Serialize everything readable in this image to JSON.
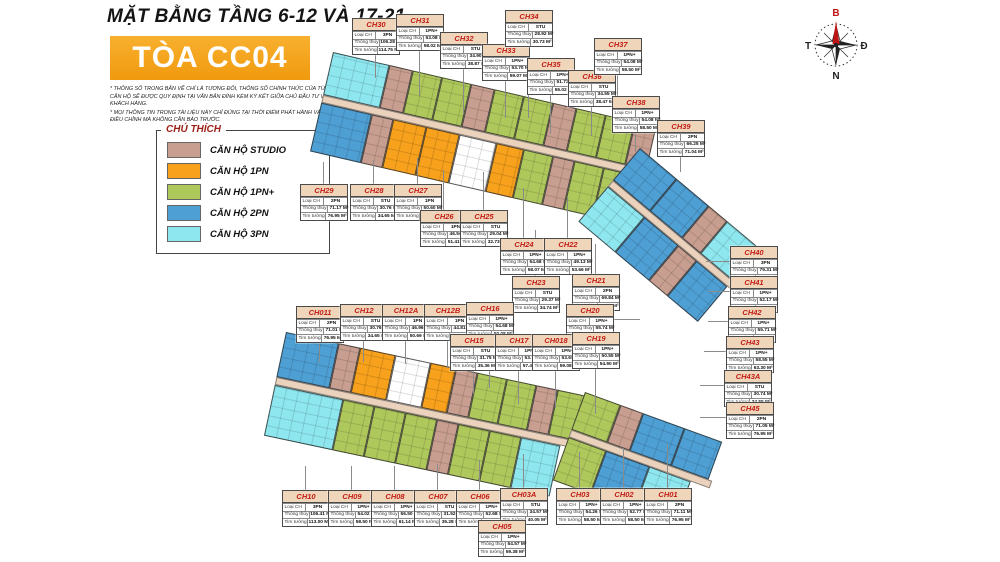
{
  "header": {
    "title": "MẶT BẰNG TẦNG 6-12 VÀ 17-21",
    "tower": "TÒA CC04",
    "notes": [
      "* THÔNG SỐ TRONG BẢN VẼ CHỈ LÀ TƯƠNG ĐỐI, THÔNG SỐ CHÍNH THỨC CỦA TỪNG CĂN HỘ SẼ ĐƯỢC QUY ĐỊNH TẠI VĂN BẢN ĐÍNH KÈM KÝ KẾT GIỮA CHỦ ĐẦU TƯ VÀ KHÁCH HÀNG.",
      "* MỌI THÔNG TIN TRONG TÀI LIỆU NÀY CHỈ ĐÚNG TẠI THỜI ĐIỂM PHÁT HÀNH VÀ CÓ THỂ ĐIỀU CHỈNH MÀ KHÔNG CẦN BÁO TRƯỚC."
    ]
  },
  "legend": {
    "title": "CHÚ THÍCH",
    "items": [
      {
        "key": "STU",
        "label": "CĂN HỘ STUDIO",
        "color": "#c79e8f"
      },
      {
        "key": "1PN",
        "label": "CĂN HỘ 1PN",
        "color": "#f7a11c"
      },
      {
        "key": "1PN+",
        "label": "CĂN HỘ 1PN+",
        "color": "#afc85c"
      },
      {
        "key": "2PN",
        "label": "CĂN HỘ 2PN",
        "color": "#4e9fd4"
      },
      {
        "key": "3PN",
        "label": "CĂN HỘ 3PN",
        "color": "#8ee7ef"
      }
    ],
    "corridor_color": "#ebd2bc",
    "core_color": "#ffffff"
  },
  "compass": {
    "north": "B",
    "east": "Đ",
    "south": "N",
    "west": "T"
  },
  "card_labels": {
    "type": "Loại CH",
    "clear": "Thông thủy",
    "wall": "Tim tường"
  },
  "units": [
    {
      "id": "CH30",
      "type": "3PN",
      "clear": "106.28 M²",
      "wall": "114.75 M²"
    },
    {
      "id": "CH31",
      "type": "1PN+",
      "clear": "53.08 M²",
      "wall": "58.02 M²"
    },
    {
      "id": "CH32",
      "type": "STU",
      "clear": "34.90 M²",
      "wall": "38.87 M²"
    },
    {
      "id": "CH33",
      "type": "1PN+",
      "clear": "53.70 M²",
      "wall": "59.07 M²"
    },
    {
      "id": "CH34",
      "type": "STU",
      "clear": "28.92 M²",
      "wall": "30.73 M²"
    },
    {
      "id": "CH35",
      "type": "1PN+",
      "clear": "51.73 M²",
      "wall": "55.02 M²"
    },
    {
      "id": "CH36",
      "type": "STU",
      "clear": "34.55 M²",
      "wall": "38.47 M²"
    },
    {
      "id": "CH37",
      "type": "1PN+",
      "clear": "54.08 M²",
      "wall": "58.50 M²"
    },
    {
      "id": "CH38",
      "type": "1PN+",
      "clear": "54.08 M²",
      "wall": "58.50 M²"
    },
    {
      "id": "CH39",
      "type": "2PN",
      "clear": "66.25 M²",
      "wall": "71.04 M²"
    },
    {
      "id": "CH29",
      "type": "2PN",
      "clear": "71.17 M²",
      "wall": "76.95 M²"
    },
    {
      "id": "CH28",
      "type": "STU",
      "clear": "30.76 M²",
      "wall": "34.65 M²"
    },
    {
      "id": "CH27",
      "type": "1PN",
      "clear": "50.60 M²",
      "wall": "55.48 M²"
    },
    {
      "id": "CH26",
      "type": "1PN",
      "clear": "46.56 M²",
      "wall": "51.41 M²"
    },
    {
      "id": "CH25",
      "type": "STU",
      "clear": "29.04 M²",
      "wall": "32.73 M²"
    },
    {
      "id": "CH24",
      "type": "1PN+",
      "clear": "54.68 M²",
      "wall": "58.07 M²"
    },
    {
      "id": "CH23",
      "type": "STU",
      "clear": "29.37 M²",
      "wall": "34.74 M²"
    },
    {
      "id": "CH22",
      "type": "1PN+",
      "clear": "49.13 M²",
      "wall": "53.66 M²"
    },
    {
      "id": "CH21",
      "type": "2PN",
      "clear": "69.84 M²",
      "wall": "74.82 M²"
    },
    {
      "id": "CH20",
      "type": "1PN+",
      "clear": "55.74 M²",
      "wall": "60.30 M²"
    },
    {
      "id": "CH40",
      "type": "3PN",
      "clear": "79.31 M²",
      "wall": "85.34 M²"
    },
    {
      "id": "CH41",
      "type": "1PN+",
      "clear": "52.17 M²",
      "wall": "56.70 M²"
    },
    {
      "id": "CH42",
      "type": "1PN+",
      "clear": "55.71 M²",
      "wall": "60.30 M²"
    },
    {
      "id": "CH43",
      "type": "1PN+",
      "clear": "58.55 M²",
      "wall": "63.30 M²"
    },
    {
      "id": "CH43A",
      "type": "STU",
      "clear": "30.74 M²",
      "wall": "34.55 M²"
    },
    {
      "id": "CH45",
      "type": "2PN",
      "clear": "71.05 M²",
      "wall": "76.95 M²"
    },
    {
      "id": "CH011",
      "type": "2PN",
      "clear": "71.01 M²",
      "wall": "76.95 M²"
    },
    {
      "id": "CH12",
      "type": "STU",
      "clear": "30.76 M²",
      "wall": "34.65 M²"
    },
    {
      "id": "CH12A",
      "type": "1PN",
      "clear": "46.96 M²",
      "wall": "50.69 M²"
    },
    {
      "id": "CH12B",
      "type": "1PN",
      "clear": "44.81 M²",
      "wall": "48.15 M²"
    },
    {
      "id": "CH16",
      "type": "1PN+",
      "clear": "54.68 M²",
      "wall": "59.08 M²"
    },
    {
      "id": "CH15",
      "type": "STU",
      "clear": "31.75 M²",
      "wall": "35.36 M²"
    },
    {
      "id": "CH17",
      "type": "1PN+",
      "clear": "53.74 M²",
      "wall": "57.45 M²"
    },
    {
      "id": "CH018",
      "type": "1PN+",
      "clear": "53.65 M²",
      "wall": "59.08 M²"
    },
    {
      "id": "CH19",
      "type": "1PN+",
      "clear": "50.55 M²",
      "wall": "54.90 M²"
    },
    {
      "id": "CH10",
      "type": "3PN",
      "clear": "106.41 M²",
      "wall": "113.00 M²"
    },
    {
      "id": "CH09",
      "type": "1PN+",
      "clear": "54.02 M²",
      "wall": "58.50 M²"
    },
    {
      "id": "CH08",
      "type": "1PN+",
      "clear": "56.50 M²",
      "wall": "61.14 M²"
    },
    {
      "id": "CH07",
      "type": "STU",
      "clear": "31.52 M²",
      "wall": "35.28 M²"
    },
    {
      "id": "CH06",
      "type": "1PN+",
      "clear": "52.68 M²",
      "wall": "58.28 M²"
    },
    {
      "id": "CH03A",
      "type": "STU",
      "clear": "34.57 M²",
      "wall": "40.05 M²"
    },
    {
      "id": "CH03",
      "type": "1PN+",
      "clear": "54.26 M²",
      "wall": "58.50 M²"
    },
    {
      "id": "CH02",
      "type": "1PN+",
      "clear": "52.77 M²",
      "wall": "58.50 M²"
    },
    {
      "id": "CH01",
      "type": "2PN",
      "clear": "71.11 M²",
      "wall": "76.95 M²"
    },
    {
      "id": "CH05",
      "type": "1PN+",
      "clear": "54.57 M²",
      "wall": "59.38 M²"
    }
  ]
}
